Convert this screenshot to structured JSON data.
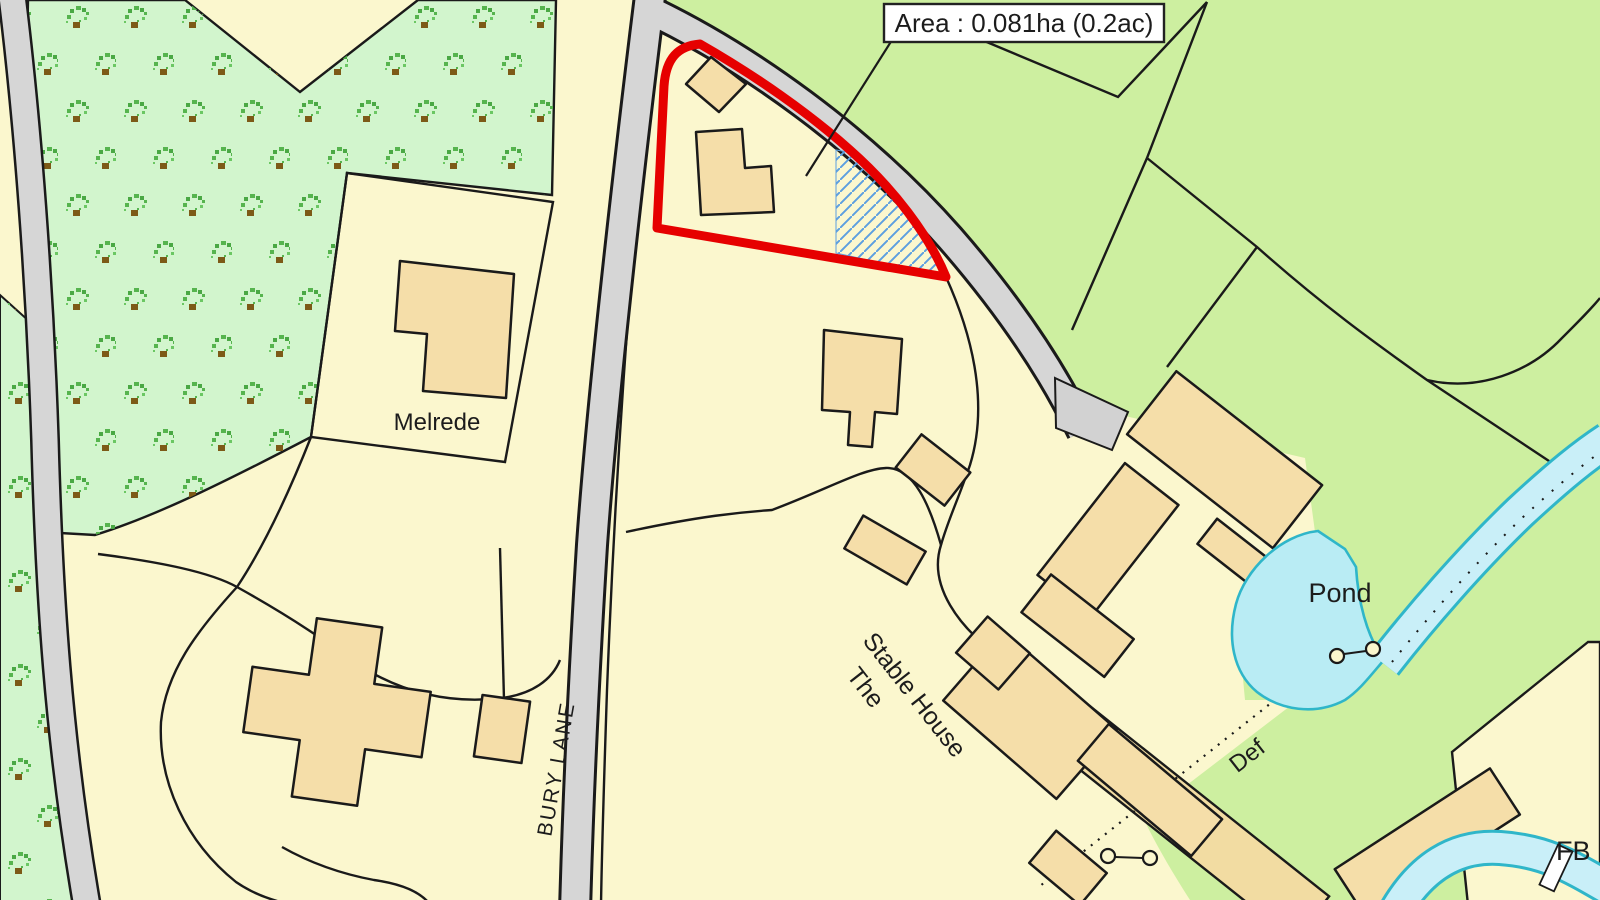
{
  "map": {
    "area_label": "Area : 0.081ha (0.2ac)",
    "labels": {
      "property_melrede": "Melrede",
      "road_bury_lane": "BURY LANE",
      "pond": "Pond",
      "stable_house_line1": "Stable House",
      "stable_house_line2": "The",
      "boundary_def": "Def",
      "footbridge": "FB"
    },
    "plot": {
      "area_hectares": "0.081ha",
      "area_acres": "0.2ac"
    },
    "colors": {
      "parcel_cream": "#FBF7CE",
      "building_tan": "#F5DEA9",
      "field_green": "#CDEFA0",
      "orchard_mint": "#D2F5CD",
      "tree_green": "#56B44E",
      "tree_trunk_brown": "#7D5A17",
      "road_grey": "#D6D6D6",
      "line_black": "#1A1A1A",
      "plot_outline_red": "#E60000",
      "hatch_blue": "#5C9FE0",
      "water_fill": "#C9EFF8",
      "water_stroke": "#2FB6C9",
      "pond_fill": "#B9ECF4",
      "label_box_bg": "#FFFFFF"
    }
  }
}
